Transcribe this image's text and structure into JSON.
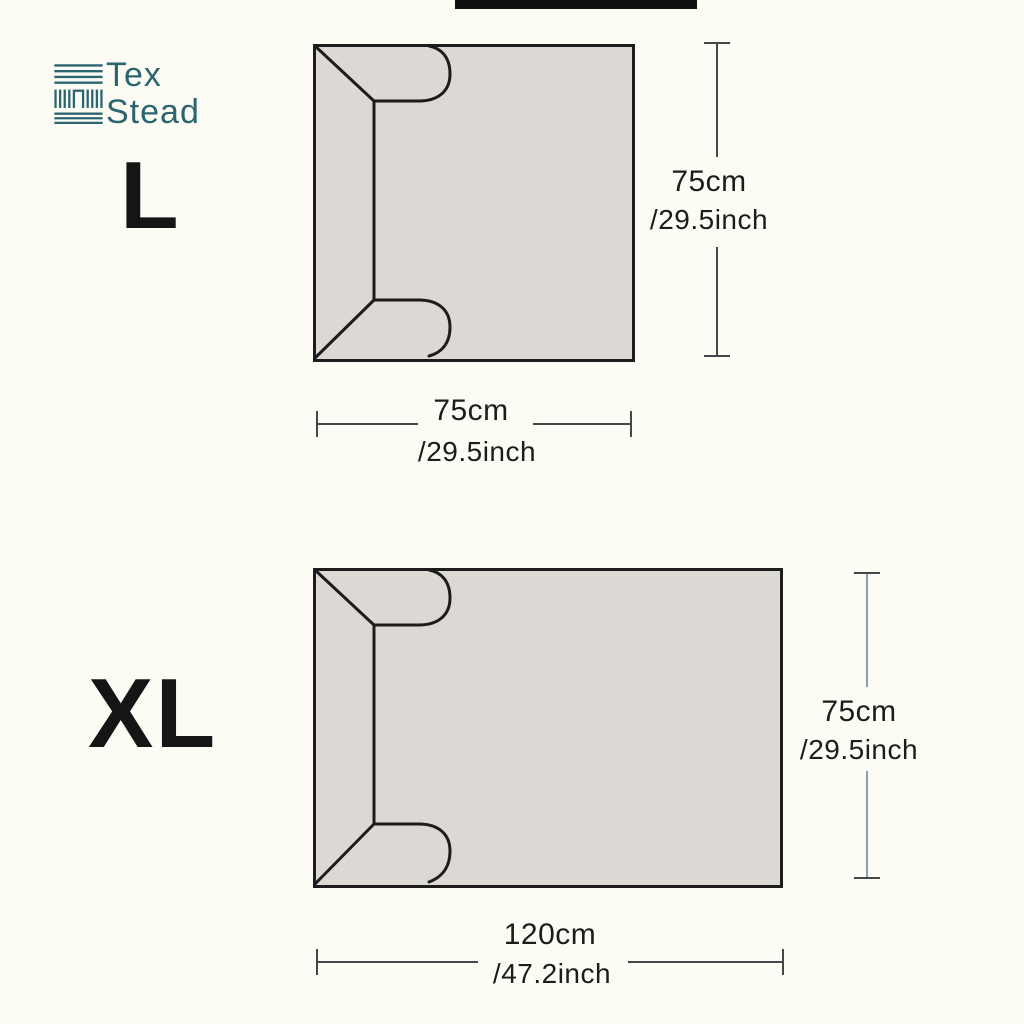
{
  "colors": {
    "background": "#fcfbf4",
    "top_bar": "#101010",
    "brand": "#2b6570",
    "outline": "#1c1c1c",
    "fill_a": "#dcd8d4",
    "dim_dark": "#46464a",
    "dim_blue": "#85a1ad",
    "text": "#1c1c1c"
  },
  "brand": {
    "line1": "Tex",
    "line2": "Stead",
    "icon": "woven-fabric-icon"
  },
  "sizes": [
    {
      "label": "L",
      "height": {
        "cm": "75cm",
        "inch": "/29.5inch"
      },
      "width": {
        "cm": "75cm",
        "inch": "/29.5inch"
      }
    },
    {
      "label": "XL",
      "height": {
        "cm": "75cm",
        "inch": "/29.5inch"
      },
      "width": {
        "cm": "120cm",
        "inch": "/47.2inch"
      }
    }
  ]
}
